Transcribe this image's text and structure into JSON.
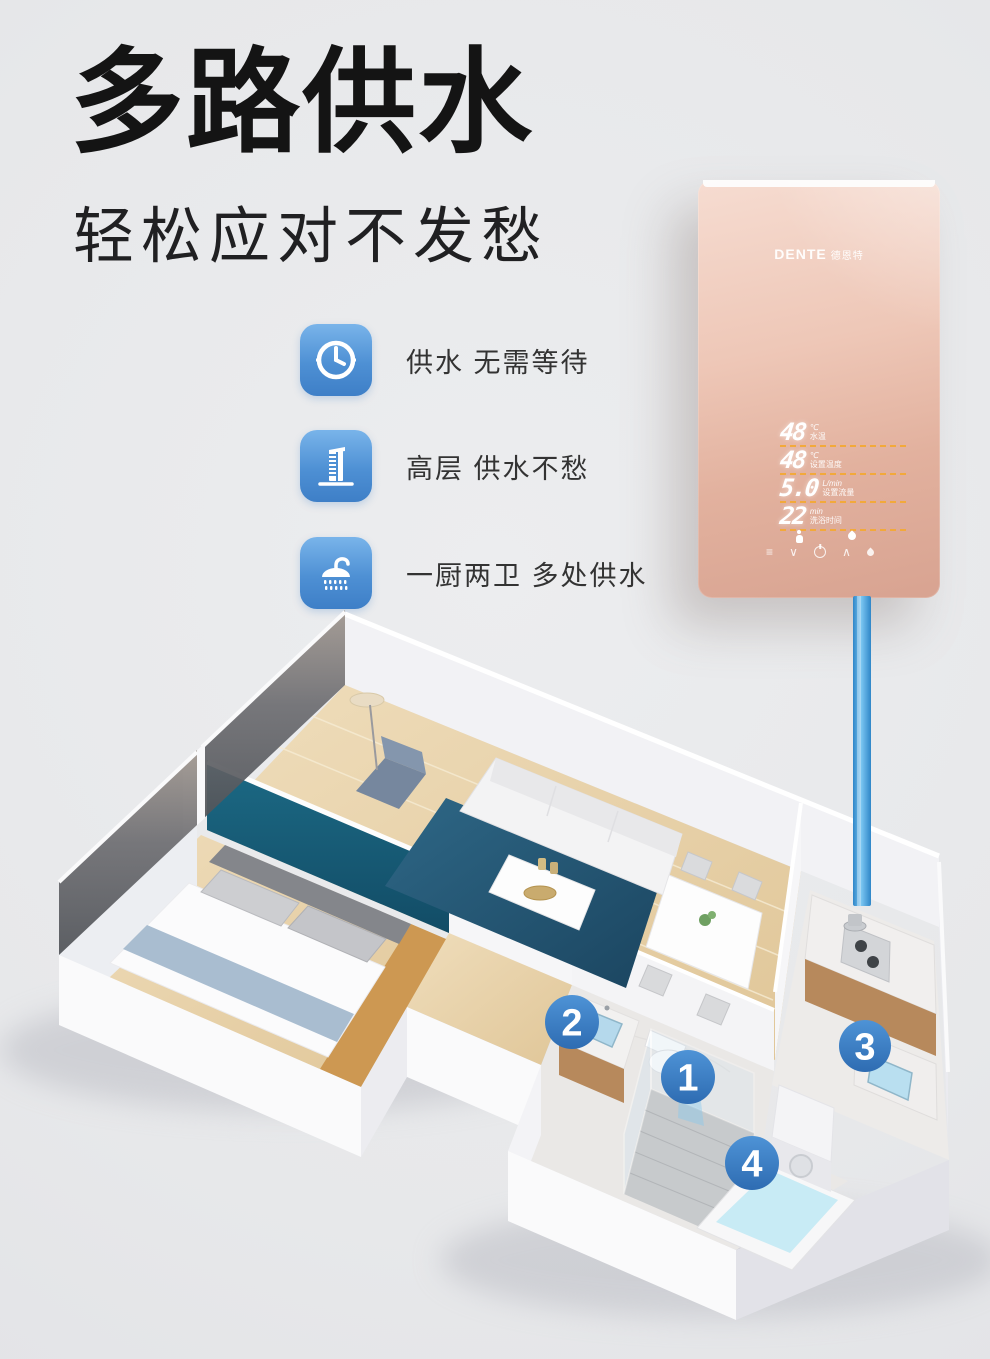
{
  "page": {
    "background": "#e8e9eb"
  },
  "header": {
    "title": "多路供水",
    "subtitle": "轻松应对不发愁"
  },
  "features": [
    {
      "icon": "clock-icon",
      "label": "供水 无需等待"
    },
    {
      "icon": "building-icon",
      "label": "高层 供水不愁"
    },
    {
      "icon": "shower-icon",
      "label": "一厨两卫 多处供水"
    }
  ],
  "heater": {
    "brand": "DENTE",
    "brand_cn": "德恩特",
    "display_rows": [
      {
        "value": "48",
        "unit": "℃",
        "label": "水温"
      },
      {
        "value": "48",
        "unit": "℃",
        "label": "设置温度"
      },
      {
        "value": "5.0",
        "unit": "L/min",
        "label": "设置流量"
      },
      {
        "value": "22",
        "unit": "min",
        "label": "洗浴时间"
      }
    ],
    "controls": {
      "menu": "≡",
      "down": "∨",
      "up": "∧"
    },
    "colors": {
      "body_top": "#f5dbd0",
      "body_bottom": "#d8a391",
      "underline": "#f2a93b"
    }
  },
  "floorplan": {
    "markers": [
      {
        "n": "1"
      },
      {
        "n": "2"
      },
      {
        "n": "3"
      },
      {
        "n": "4"
      }
    ],
    "colors": {
      "marker_blue": "#3a7cc4",
      "pipe_blue": "#3f97d8",
      "teal_wall": "#19607b",
      "rug": "#24526e",
      "wood_floor": "#e9d6b2"
    }
  }
}
